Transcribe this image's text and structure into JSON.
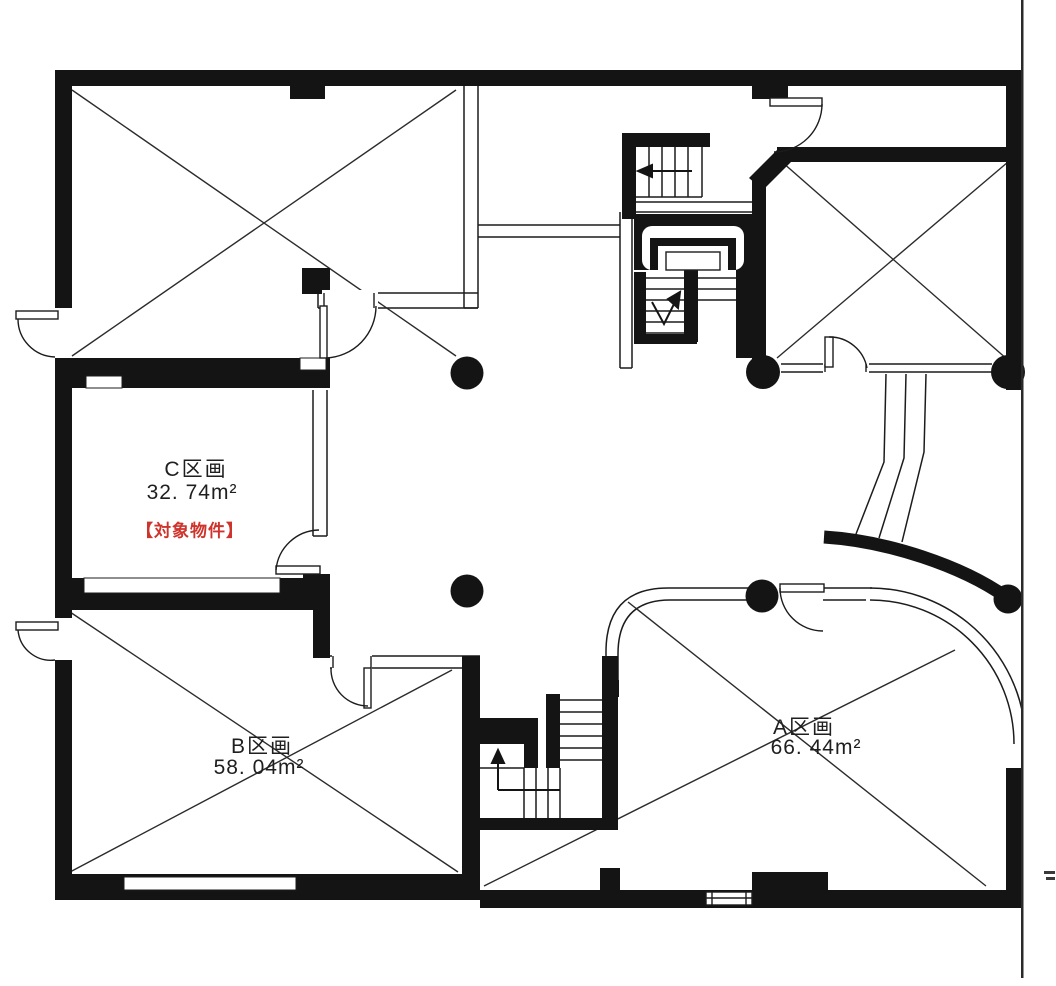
{
  "floor_plan": {
    "type": "building-floor-plan",
    "rooms": [
      {
        "id": "c",
        "name": "C区画",
        "area": "32. 74m²",
        "badge": "【対象物件】"
      },
      {
        "id": "b",
        "name": "B区画",
        "area": "58. 04m²"
      },
      {
        "id": "a",
        "name": "A区画",
        "area": "66. 44m²"
      }
    ],
    "badge_color": "#cf342c",
    "wall_color": "#141414",
    "line_color": "#1c1c1c"
  }
}
